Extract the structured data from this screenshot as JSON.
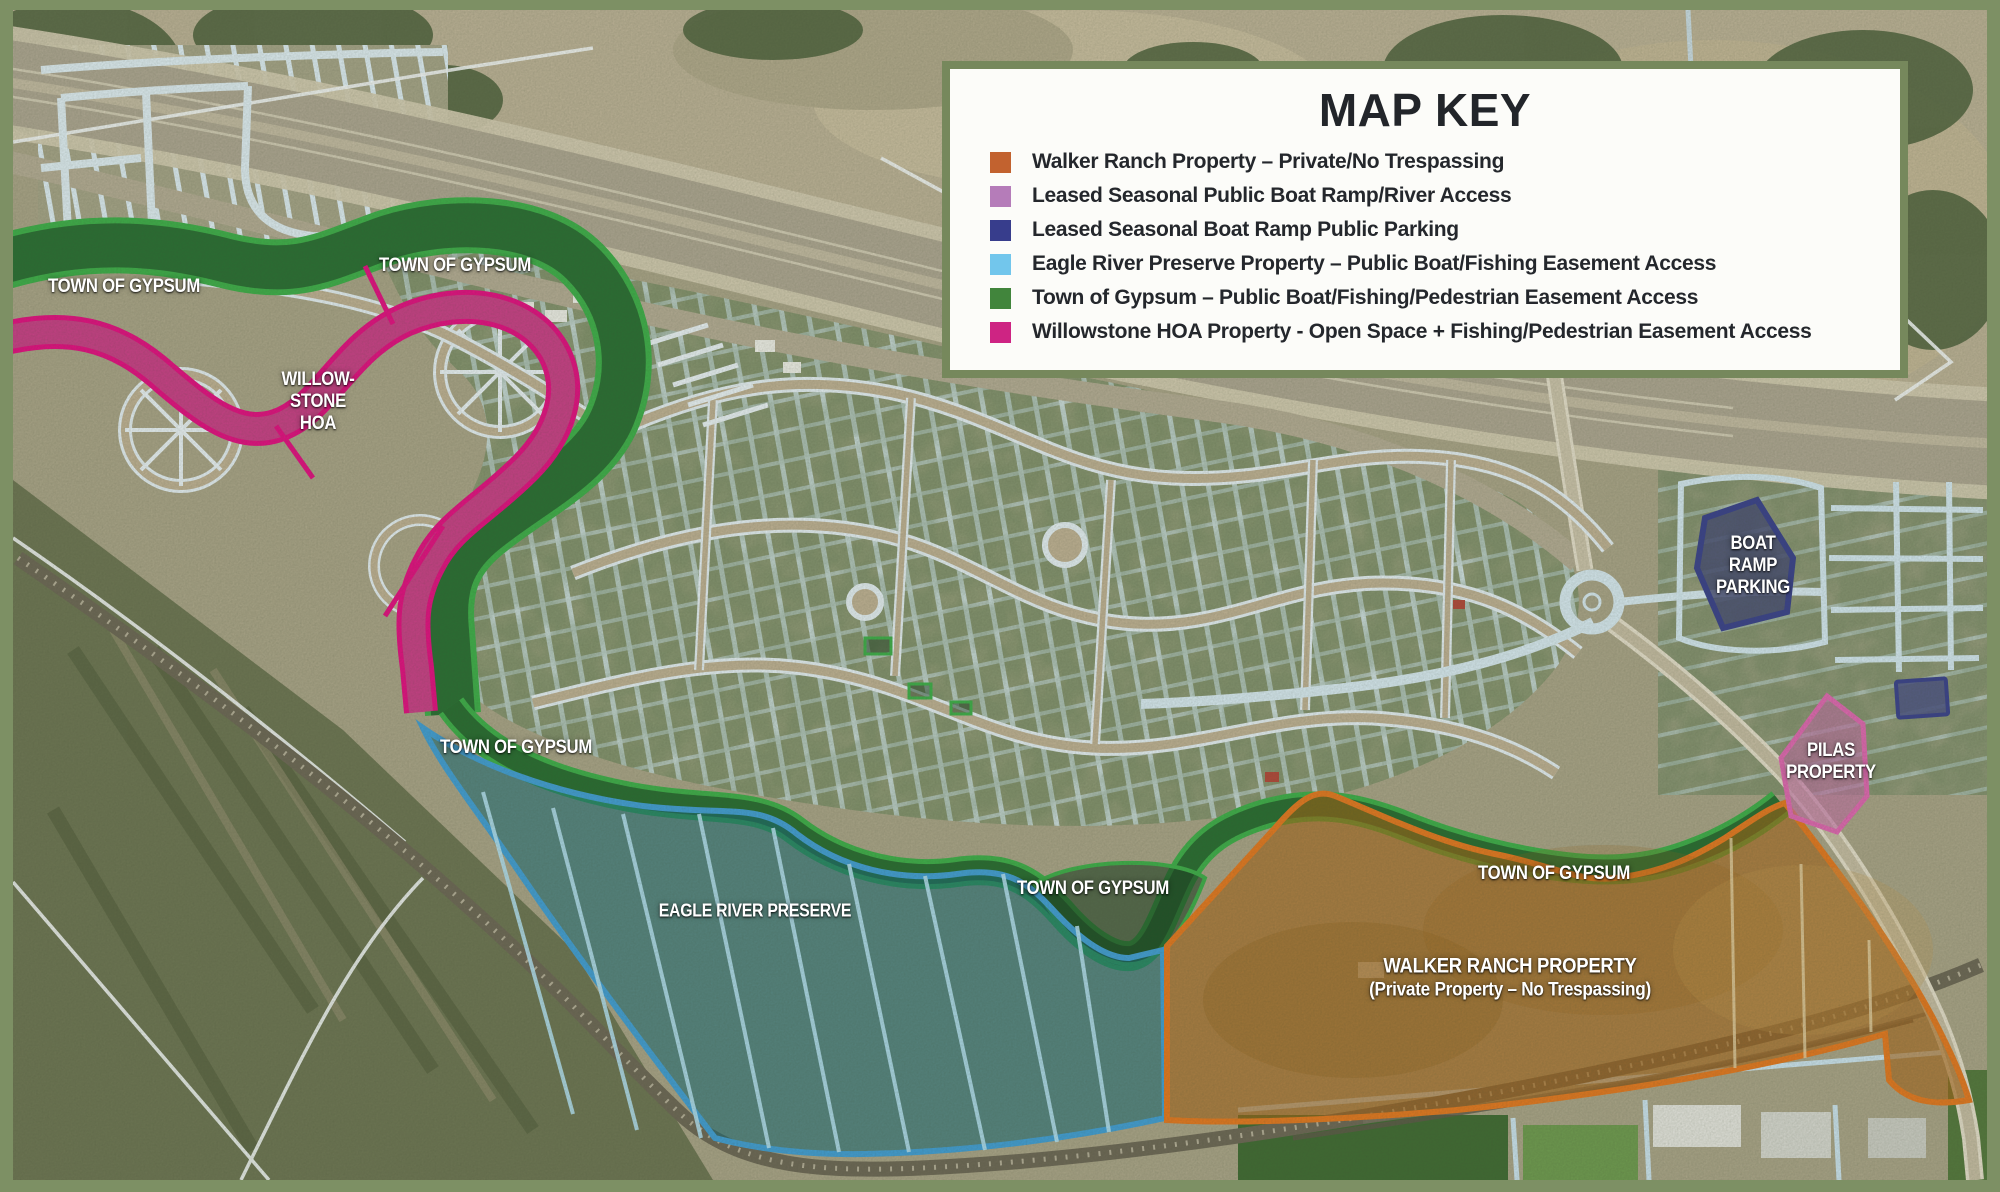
{
  "legend": {
    "title": "MAP KEY",
    "items": [
      {
        "color": "#c2622f",
        "label": "Walker Ranch Property – Private/No Trespassing"
      },
      {
        "color": "#b57cb9",
        "label": "Leased Seasonal Public Boat Ramp/River Access"
      },
      {
        "color": "#373d8c",
        "label": "Leased Seasonal Boat Ramp Public Parking"
      },
      {
        "color": "#72c6ec",
        "label": "Eagle River Preserve Property – Public Boat/Fishing Easement Access"
      },
      {
        "color": "#41853c",
        "label": "Town of Gypsum – Public Boat/Fishing/Pedestrian Easement Access"
      },
      {
        "color": "#ce2483",
        "label": "Willowstone HOA Property - Open Space + Fishing/Pedestrian Easement Access"
      }
    ]
  },
  "labels": {
    "town_of_gypsum": "TOWN OF GYPSUM",
    "willowstone_hoa": [
      "WILLOW-",
      "STONE",
      "HOA"
    ],
    "eagle_river_preserve": "EAGLE RIVER PRESERVE",
    "walker_ranch": [
      "WALKER RANCH PROPERTY",
      "(Private Property – No Trespassing)"
    ],
    "boat_ramp_parking": [
      "BOAT",
      "RAMP",
      "PARKING"
    ],
    "pilas_property": [
      "PILAS",
      "PROPERTY"
    ]
  },
  "colors": {
    "frame": "#7d9064",
    "walker_ranch_outline": "#e8791f",
    "willowstone_outline": "#e80c84",
    "town_of_gypsum_outline": "#3db14a",
    "eagle_river_outline": "#41a0d9",
    "parking_outline": "#39418f",
    "pilas_outline": "#e468b5"
  }
}
